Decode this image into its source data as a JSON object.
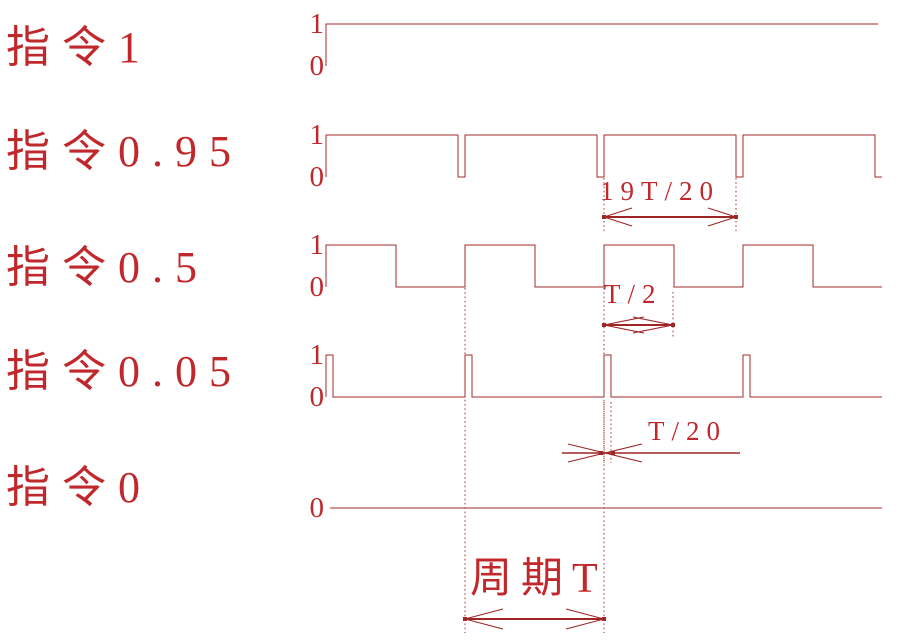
{
  "colors": {
    "line": "#a62b2b",
    "dim": "#9e2626",
    "text": "#c0282c"
  },
  "chart_data": {
    "type": "digital-timing",
    "period_symbol": "T",
    "levels": [
      "1",
      "0"
    ],
    "rows": [
      {
        "label": "指令1",
        "duty": 1.0,
        "axis": [
          "1",
          "0"
        ]
      },
      {
        "label": "指令0.95",
        "duty": 0.95,
        "axis": [
          "1",
          "0"
        ]
      },
      {
        "label": "指令0.5",
        "duty": 0.5,
        "axis": [
          "1",
          "0"
        ]
      },
      {
        "label": "指令0.05",
        "duty": 0.05,
        "axis": [
          "0",
          "0"
        ]
      },
      {
        "label": "指令0",
        "duty": 0.0,
        "axis": [
          "0"
        ]
      }
    ],
    "annotations": [
      {
        "id": "dim-19t20",
        "label": "19T/20"
      },
      {
        "id": "dim-t2",
        "label": "T/2"
      },
      {
        "id": "dim-t20",
        "label": "T/20"
      },
      {
        "id": "dim-period",
        "label": "周期T"
      }
    ]
  }
}
